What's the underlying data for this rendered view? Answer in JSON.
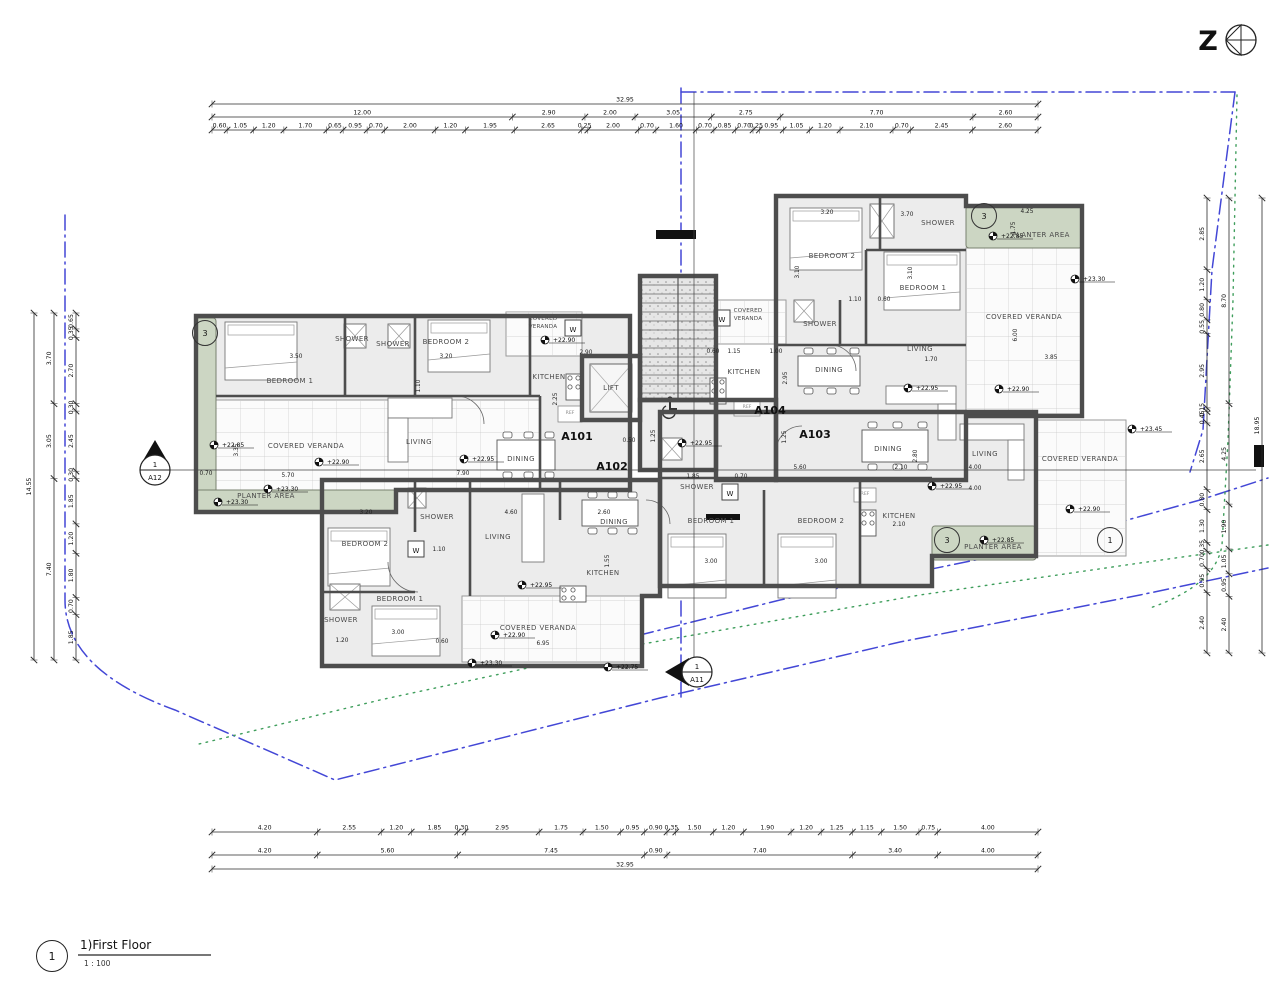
{
  "colors": {
    "wall": "#4d4d4d",
    "room_fill": "#ececec",
    "veranda_fill": "#fbfbfb",
    "grid_line": "#c9c9c9",
    "planter_fill": "#ccd6c3",
    "boundary_blue": "#4347d6",
    "contour_green": "#3f9e5c",
    "dim_line": "#2a2a2a",
    "paper": "#ffffff"
  },
  "north_arrow": {
    "letter": "Z"
  },
  "title_block": {
    "number": "1",
    "label": "1)First Floor",
    "scale": "1 : 100"
  },
  "unit_labels": [
    {
      "label": "A101",
      "x": 577,
      "y": 440
    },
    {
      "label": "A102",
      "x": 612,
      "y": 470
    },
    {
      "label": "A103",
      "x": 815,
      "y": 438
    },
    {
      "label": "A104",
      "x": 770,
      "y": 414
    }
  ],
  "rooms": [
    [
      "BEDROOM 1",
      290,
      383
    ],
    [
      "SHOWER",
      352,
      341
    ],
    [
      "SHOWER",
      393,
      346
    ],
    [
      "BEDROOM 2",
      446,
      344
    ],
    [
      "KITCHEN",
      549,
      379
    ],
    [
      "LIFT",
      611,
      390
    ],
    [
      "LIVING",
      419,
      444
    ],
    [
      "DINING",
      521,
      461
    ],
    [
      "COVERED VERANDA",
      306,
      448
    ],
    [
      "PLANTER AREA",
      266,
      498
    ],
    [
      "COVERED VERANDA",
      543,
      320,
      "tl"
    ],
    [
      "COVERED VERANDA",
      748,
      312,
      "tl"
    ],
    [
      "KITCHEN",
      744,
      374
    ],
    [
      "BEDROOM 2",
      832,
      258
    ],
    [
      "SHOWER",
      938,
      225
    ],
    [
      "BEDROOM 1",
      923,
      290
    ],
    [
      "SHOWER",
      820,
      326
    ],
    [
      "DINING",
      829,
      372
    ],
    [
      "LIVING",
      920,
      351
    ],
    [
      "COVERED VERANDA",
      1024,
      319
    ],
    [
      "PLANTER AREA",
      1041,
      237
    ],
    [
      "DINING",
      888,
      451
    ],
    [
      "LIVING",
      985,
      456
    ],
    [
      "KITCHEN",
      899,
      518
    ],
    [
      "BEDROOM 1",
      711,
      523
    ],
    [
      "BEDROOM 2",
      821,
      523
    ],
    [
      "SHOWER",
      697,
      489
    ],
    [
      "COVERED VERANDA",
      1080,
      461
    ],
    [
      "PLANTER AREA",
      993,
      549
    ],
    [
      "BEDROOM 2",
      365,
      546
    ],
    [
      "SHOWER",
      437,
      519
    ],
    [
      "BEDROOM 1",
      400,
      601
    ],
    [
      "SHOWER",
      341,
      622
    ],
    [
      "LIVING",
      498,
      539
    ],
    [
      "DINING",
      614,
      524
    ],
    [
      "KITCHEN",
      603,
      575
    ],
    [
      "COVERED VERANDA",
      538,
      630
    ]
  ],
  "ref_labels": [
    [
      570,
      414
    ],
    [
      747,
      408
    ],
    [
      865,
      495
    ]
  ],
  "ref_text": "REF",
  "washer_letter": "W",
  "washers": [
    [
      565,
      320
    ],
    [
      714,
      310
    ],
    [
      722,
      484
    ],
    [
      408,
      541
    ]
  ],
  "inline_dims": [
    [
      "3.50",
      296,
      358,
      0
    ],
    [
      "3.20",
      446,
      358,
      0
    ],
    [
      "1.10",
      420,
      386,
      90
    ],
    [
      "3.35",
      238,
      450,
      90
    ],
    [
      "5.70",
      288,
      477,
      0
    ],
    [
      "2.90",
      586,
      354,
      0
    ],
    [
      "2.25",
      557,
      399,
      90
    ],
    [
      "7.90",
      463,
      475,
      0
    ],
    [
      "0.70",
      206,
      475,
      0
    ],
    [
      "3.20",
      827,
      214,
      0
    ],
    [
      "3.70",
      907,
      216,
      0
    ],
    [
      "3.10",
      799,
      272,
      90
    ],
    [
      "3.10",
      912,
      273,
      90
    ],
    [
      "1.10",
      855,
      301,
      0
    ],
    [
      "0.60",
      884,
      301,
      0
    ],
    [
      "2.95",
      787,
      378,
      90
    ],
    [
      "1.70",
      931,
      361,
      0
    ],
    [
      "6.00",
      1017,
      335,
      90
    ],
    [
      "3.85",
      1051,
      359,
      0
    ],
    [
      "4.25",
      1027,
      213,
      0
    ],
    [
      "1.75",
      1015,
      228,
      90
    ],
    [
      "0.60",
      713,
      353,
      0
    ],
    [
      "1.15",
      734,
      353,
      0
    ],
    [
      "1.00",
      776,
      353,
      0
    ],
    [
      "5.60",
      800,
      469,
      0
    ],
    [
      "2.10",
      901,
      469,
      0
    ],
    [
      "4.00",
      975,
      469,
      0
    ],
    [
      "4.00",
      975,
      490,
      0
    ],
    [
      "2.80",
      917,
      456,
      90
    ],
    [
      "2.10",
      899,
      526,
      0
    ],
    [
      "3.00",
      711,
      563,
      0
    ],
    [
      "3.00",
      821,
      563,
      0
    ],
    [
      "1.25",
      786,
      437,
      90
    ],
    [
      "1.85",
      693,
      478,
      0
    ],
    [
      "0.70",
      741,
      478,
      0
    ],
    [
      "3.20",
      366,
      514,
      0
    ],
    [
      "4.60",
      511,
      514,
      0
    ],
    [
      "2.60",
      604,
      514,
      0
    ],
    [
      "1.10",
      439,
      551,
      0
    ],
    [
      "3.00",
      398,
      634,
      0
    ],
    [
      "1.20",
      342,
      642,
      0
    ],
    [
      "0.60",
      442,
      643,
      0
    ],
    [
      "6.95",
      543,
      645,
      0
    ],
    [
      "1.55",
      609,
      561,
      90
    ],
    [
      "1.25",
      655,
      436,
      90
    ],
    [
      "0.50",
      629,
      442,
      0
    ]
  ],
  "elevations": [
    [
      "+22.85",
      222,
      447
    ],
    [
      "+22.95",
      472,
      461
    ],
    [
      "+22.90",
      327,
      464
    ],
    [
      "+23.30",
      276,
      491
    ],
    [
      "+23.30",
      226,
      504
    ],
    [
      "+22.90",
      553,
      342
    ],
    [
      "+22.95",
      690,
      445
    ],
    [
      "+22.85",
      1001,
      238
    ],
    [
      "+23.30",
      1083,
      281
    ],
    [
      "+22.95",
      916,
      390
    ],
    [
      "+22.90",
      1007,
      391
    ],
    [
      "+23.45",
      1140,
      431
    ],
    [
      "+22.95",
      940,
      488
    ],
    [
      "+22.85",
      992,
      542
    ],
    [
      "+22.90",
      1078,
      511
    ],
    [
      "+22.95",
      530,
      587
    ],
    [
      "+22.90",
      503,
      637
    ],
    [
      "+23.30",
      480,
      665
    ],
    [
      "+22.75",
      616,
      669
    ]
  ],
  "detail_markers": [
    {
      "n": "3",
      "x": 205,
      "y": 333
    },
    {
      "n": "3",
      "x": 984,
      "y": 216
    },
    {
      "n": "3",
      "x": 947,
      "y": 540
    },
    {
      "n": "1",
      "x": 1110,
      "y": 540
    }
  ],
  "section_markers": [
    {
      "num": "1",
      "label": "A12",
      "x": 155,
      "y": 470,
      "dir": "up"
    },
    {
      "num": "1",
      "label": "A11",
      "x": 697,
      "y": 672,
      "dir": "left"
    }
  ],
  "dimension_chains": [
    {
      "id": "top",
      "orientation": "h",
      "x0": 212,
      "x1": 1038,
      "rows": [
        {
          "offset": 104,
          "values": [
            "32.95"
          ]
        },
        {
          "offset": 117,
          "values": [
            "12.00",
            "2.90",
            "2.00",
            "3.05",
            "2.75",
            "7.70",
            "2.60"
          ]
        },
        {
          "offset": 130,
          "values": [
            "0.60",
            "1.05",
            "1.20",
            "1.70",
            "0.65",
            "0.95",
            "0.70",
            "2.00",
            "1.20",
            "1.95",
            "2.65",
            "0.25",
            "2.00",
            "0.70",
            "1.60",
            "0.70",
            "0.85",
            "0.70",
            "0.25",
            "0.95",
            "1.05",
            "1.20",
            "2.10",
            "0.70",
            "2.45",
            "2.60"
          ]
        }
      ]
    },
    {
      "id": "bottom",
      "orientation": "h",
      "x0": 212,
      "x1": 1038,
      "rows": [
        {
          "offset": 832,
          "values": [
            "4.20",
            "2.55",
            "1.20",
            "1.85",
            "0.30",
            "2.95",
            "1.75",
            "1.50",
            "0.95",
            "0.90",
            "0.35",
            "1.50",
            "1.20",
            "1.90",
            "1.20",
            "1.25",
            "1.15",
            "1.50",
            "0.75",
            "4.00"
          ]
        },
        {
          "offset": 855,
          "values": [
            "4.20",
            "5.60",
            "7.45",
            "0.90",
            "7.40",
            "3.40",
            "4.00"
          ]
        },
        {
          "offset": 869,
          "values": [
            "32.95"
          ]
        }
      ]
    },
    {
      "id": "left",
      "orientation": "v",
      "y0": 313,
      "y1": 660,
      "rows": [
        {
          "offset": 34,
          "values": [
            "14.55"
          ]
        },
        {
          "offset": 54,
          "values": [
            "3.70",
            "3.05",
            "7.40"
          ]
        },
        {
          "offset": 76,
          "values": [
            "0.65",
            "0.35",
            "2.70",
            "0.30",
            "2.45",
            "0.30",
            "1.85",
            "1.20",
            "1.80",
            "0.70",
            "1.85"
          ]
        }
      ]
    },
    {
      "id": "right",
      "orientation": "v",
      "y0": 198,
      "y1": 653,
      "rows": [
        {
          "offset": 1262,
          "values": [
            "18.95"
          ]
        },
        {
          "offset": 1229,
          "values": [
            "8.70",
            "4.25",
            "1.90",
            "1.05",
            "0.95",
            "2.40"
          ]
        },
        {
          "offset": 1207,
          "values": [
            "2.85",
            "1.20",
            "0.80",
            "0.55",
            "2.95",
            "0.15",
            "0.45",
            "2.65",
            "0.80",
            "1.30",
            "0.35",
            "0.70",
            "0.95",
            "2.40"
          ]
        }
      ]
    }
  ]
}
